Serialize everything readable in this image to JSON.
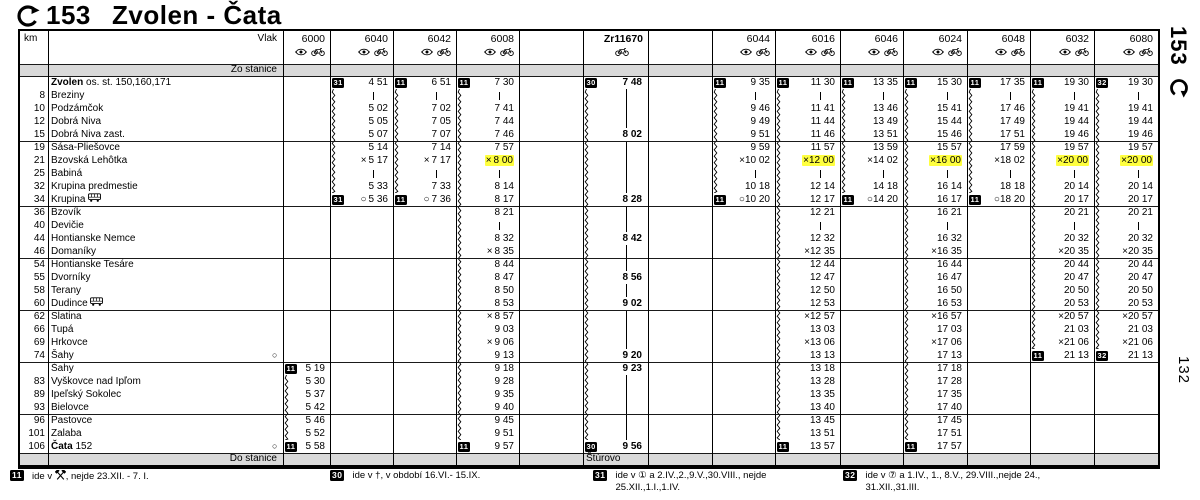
{
  "title": {
    "route_number": "153",
    "name": "Zvolen - Čata"
  },
  "margin": {
    "route": "153",
    "page": "132"
  },
  "header": {
    "km": "km",
    "vlak": "Vlak",
    "zo": "Zo stanice",
    "do": "Do stanice"
  },
  "colors": {
    "highlight": "#ffff3f",
    "band_gray": "#d9d9d9",
    "ink": "#000000",
    "paper": "#ffffff"
  },
  "stations": [
    {
      "km": "",
      "name": "Zvolen",
      "suffix": "os. st. 150,160,171",
      "bold": true
    },
    {
      "km": "8",
      "name": "Breziny"
    },
    {
      "km": "10",
      "name": "Podzámčok"
    },
    {
      "km": "12",
      "name": "Dobrá Niva"
    },
    {
      "km": "15",
      "name": "Dobrá Niva zast."
    },
    {
      "km": "19",
      "name": "Sása-Pliešovce"
    },
    {
      "km": "21",
      "name": "Bzovská Lehôtka"
    },
    {
      "km": "25",
      "name": "Babiná"
    },
    {
      "km": "32",
      "name": "Krupina predmestie"
    },
    {
      "km": "34",
      "name": "Krupina",
      "bus": true
    },
    {
      "km": "36",
      "name": "Bzovík"
    },
    {
      "km": "40",
      "name": "Devičie"
    },
    {
      "km": "44",
      "name": "Hontianske Nemce"
    },
    {
      "km": "46",
      "name": "Domaníky"
    },
    {
      "km": "54",
      "name": "Hontianske Tesáre"
    },
    {
      "km": "55",
      "name": "Dvorníky"
    },
    {
      "km": "58",
      "name": "Terany"
    },
    {
      "km": "60",
      "name": "Dudince",
      "bus": true
    },
    {
      "km": "62",
      "name": "Slatina"
    },
    {
      "km": "66",
      "name": "Tupá"
    },
    {
      "km": "69",
      "name": "Hrkovce"
    },
    {
      "km": "74",
      "name": "Šahy",
      "circle": true
    },
    {
      "km": "",
      "name": "Šahy"
    },
    {
      "km": "83",
      "name": "Vyškovce nad Ipľom"
    },
    {
      "km": "89",
      "name": "Ipeľský Sokolec"
    },
    {
      "km": "93",
      "name": "Bielovce"
    },
    {
      "km": "96",
      "name": "Pastovce"
    },
    {
      "km": "101",
      "name": "Zalaba"
    },
    {
      "km": "106",
      "name": "Čata",
      "suffix": "152",
      "bold": true,
      "circle": true
    }
  ],
  "section_breaks": [
    4,
    9,
    13,
    17,
    21,
    25
  ],
  "columns": [
    {
      "number": "6000",
      "icons": [
        "eye",
        "bike"
      ],
      "wavy": [
        23,
        27
      ],
      "cells": [
        "",
        "",
        "",
        "",
        "",
        "",
        "",
        "",
        "",
        "",
        "",
        "",
        "",
        "",
        "",
        "",
        "",
        "",
        "",
        "",
        "",
        "",
        {
          "b": "11",
          "t": "5 19"
        },
        "5 30",
        "5 37",
        "5 42",
        "5 46",
        "5 52",
        {
          "b": "11",
          "t": "5 58"
        }
      ]
    },
    {
      "number": "6040",
      "icons": [
        "eye",
        "bike"
      ],
      "wavy": [
        1,
        8
      ],
      "cells": [
        {
          "b": "31",
          "t": "4 51"
        },
        "|",
        "5 02",
        "5 05",
        "5 07",
        "5 14",
        {
          "p": "×",
          "t": "5 17"
        },
        "|",
        "5 33",
        {
          "b": "31",
          "p": "○",
          "t": "5 36"
        },
        "",
        "",
        "",
        "",
        "",
        "",
        "",
        "",
        "",
        "",
        "",
        "",
        "",
        "",
        "",
        "",
        "",
        "",
        ""
      ]
    },
    {
      "number": "6042",
      "icons": [
        "eye",
        "bike"
      ],
      "wavy": [
        1,
        8
      ],
      "cells": [
        {
          "b": "11",
          "t": "6 51"
        },
        "|",
        "7 02",
        "7 05",
        "7 07",
        "7 14",
        {
          "p": "×",
          "t": "7 17"
        },
        "|",
        "7 33",
        {
          "b": "11",
          "p": "○",
          "t": "7 36"
        },
        "",
        "",
        "",
        "",
        "",
        "",
        "",
        "",
        "",
        "",
        "",
        "",
        "",
        "",
        "",
        "",
        "",
        "",
        ""
      ]
    },
    {
      "number": "6008",
      "icons": [
        "eye",
        "bike"
      ],
      "wavy": [
        1,
        27
      ],
      "cells": [
        {
          "b": "11",
          "t": "7 30"
        },
        "|",
        "7 41",
        "7 44",
        "7 46",
        "7 57",
        {
          "p": "×",
          "t": "8 00",
          "h": true
        },
        "|",
        "8 14",
        "8 17",
        "8 21",
        "|",
        "8 32",
        {
          "p": "×",
          "t": "8 35"
        },
        "8 44",
        "8 47",
        "8 50",
        "8 53",
        {
          "p": "×",
          "t": "8 57"
        },
        "9 03",
        {
          "p": "×",
          "t": "9 06"
        },
        "9 13",
        "9 18",
        "9 28",
        "9 35",
        "9 40",
        "9 45",
        "9 51",
        {
          "b": "11",
          "t": "9 57"
        }
      ]
    },
    {
      "number": "",
      "icons": [],
      "cells": []
    },
    {
      "number": "Zr11670",
      "bold": true,
      "icons": [
        "bike"
      ],
      "wavy": [
        1,
        27
      ],
      "destination": "Štúrovo",
      "cells": [
        {
          "b": "30",
          "t": "7 48"
        },
        "l",
        "l",
        "l",
        "8 02",
        "l",
        "l",
        "l",
        "l",
        "8 28",
        "l",
        "l",
        "8 42",
        "l",
        "l",
        "8 56",
        "l",
        "9 02",
        "l",
        "l",
        "l",
        "9 20",
        "9 23",
        "l",
        "l",
        "l",
        "l",
        "l",
        {
          "b": "30",
          "t": "9 56"
        }
      ]
    },
    {
      "number": "",
      "icons": [],
      "cells": []
    },
    {
      "number": "6044",
      "icons": [
        "eye",
        "bike"
      ],
      "wavy": [
        1,
        8
      ],
      "cells": [
        {
          "b": "11",
          "t": "9 35"
        },
        "|",
        "9 46",
        "9 49",
        "9 51",
        "9 59",
        {
          "p": "×",
          "t": "10 02"
        },
        "|",
        "10 18",
        {
          "b": "11",
          "p": "○",
          "t": "10 20"
        },
        "",
        "",
        "",
        "",
        "",
        "",
        "",
        "",
        "",
        "",
        "",
        "",
        "",
        "",
        "",
        "",
        "",
        "",
        ""
      ]
    },
    {
      "number": "6016",
      "icons": [
        "eye",
        "bike"
      ],
      "wavy": [
        1,
        27
      ],
      "cells": [
        {
          "b": "11",
          "t": "11 30"
        },
        "|",
        "11 41",
        "11 44",
        "11 46",
        "11 57",
        {
          "p": "×",
          "t": "12 00",
          "h": true
        },
        "|",
        "12 14",
        "12 17",
        "12 21",
        "|",
        "12 32",
        {
          "p": "×",
          "t": "12 35"
        },
        "12 44",
        "12 47",
        "12 50",
        "12 53",
        {
          "p": "×",
          "t": "12 57"
        },
        "13 03",
        {
          "p": "×",
          "t": "13 06"
        },
        "13 13",
        "13 18",
        "13 28",
        "13 35",
        "13 40",
        "13 45",
        "13 51",
        {
          "b": "11",
          "t": "13 57"
        }
      ]
    },
    {
      "number": "6046",
      "icons": [
        "eye",
        "bike"
      ],
      "wavy": [
        1,
        8
      ],
      "cells": [
        {
          "b": "11",
          "t": "13 35"
        },
        "|",
        "13 46",
        "13 49",
        "13 51",
        "13 59",
        {
          "p": "×",
          "t": "14 02"
        },
        "|",
        "14 18",
        {
          "b": "11",
          "p": "○",
          "t": "14 20"
        },
        "",
        "",
        "",
        "",
        "",
        "",
        "",
        "",
        "",
        "",
        "",
        "",
        "",
        "",
        "",
        "",
        "",
        "",
        ""
      ]
    },
    {
      "number": "6024",
      "icons": [
        "eye",
        "bike"
      ],
      "wavy": [
        1,
        27
      ],
      "cells": [
        {
          "b": "11",
          "t": "15 30"
        },
        "|",
        "15 41",
        "15 44",
        "15 46",
        "15 57",
        {
          "p": "×",
          "t": "16 00",
          "h": true
        },
        "|",
        "16 14",
        "16 17",
        "16 21",
        "|",
        "16 32",
        {
          "p": "×",
          "t": "16 35"
        },
        "16 44",
        "16 47",
        "16 50",
        "16 53",
        {
          "p": "×",
          "t": "16 57"
        },
        "17 03",
        {
          "p": "×",
          "t": "17 06"
        },
        "17 13",
        "17 18",
        "17 28",
        "17 35",
        "17 40",
        "17 45",
        "17 51",
        {
          "b": "11",
          "t": "17 57"
        }
      ]
    },
    {
      "number": "6048",
      "icons": [
        "eye",
        "bike"
      ],
      "wavy": [
        1,
        8
      ],
      "cells": [
        {
          "b": "11",
          "t": "17 35"
        },
        "|",
        "17 46",
        "17 49",
        "17 51",
        "17 59",
        {
          "p": "×",
          "t": "18 02"
        },
        "|",
        "18 18",
        {
          "b": "11",
          "p": "○",
          "t": "18 20"
        },
        "",
        "",
        "",
        "",
        "",
        "",
        "",
        "",
        "",
        "",
        "",
        "",
        "",
        "",
        "",
        "",
        "",
        "",
        ""
      ]
    },
    {
      "number": "6032",
      "icons": [
        "eye",
        "bike"
      ],
      "wavy": [
        1,
        20
      ],
      "cells": [
        {
          "b": "11",
          "t": "19 30"
        },
        "|",
        "19 41",
        "19 44",
        "19 46",
        "19 57",
        {
          "p": "×",
          "t": "20 00",
          "h": true
        },
        "|",
        "20 14",
        "20 17",
        "20 21",
        "|",
        "20 32",
        {
          "p": "×",
          "t": "20 35"
        },
        "20 44",
        "20 47",
        "20 50",
        "20 53",
        {
          "p": "×",
          "t": "20 57"
        },
        "21 03",
        {
          "p": "×",
          "t": "21 06"
        },
        {
          "b": "11",
          "t": "21 13"
        },
        "",
        "",
        "",
        "",
        "",
        "",
        ""
      ]
    },
    {
      "number": "6080",
      "icons": [
        "eye",
        "bike"
      ],
      "wavy": [
        1,
        20
      ],
      "cells": [
        {
          "b": "32",
          "t": "19 30"
        },
        "|",
        "19 41",
        "19 44",
        "19 46",
        "19 57",
        {
          "p": "×",
          "t": "20 00",
          "h": true
        },
        "|",
        "20 14",
        "20 17",
        "20 21",
        "|",
        "20 32",
        {
          "p": "×",
          "t": "20 35"
        },
        "20 44",
        "20 47",
        "20 50",
        "20 53",
        {
          "p": "×",
          "t": "20 57"
        },
        "21 03",
        {
          "p": "×",
          "t": "21 06"
        },
        {
          "b": "32",
          "t": "21 13"
        },
        "",
        "",
        "",
        "",
        "",
        "",
        ""
      ]
    }
  ],
  "notes": [
    {
      "badge": "11",
      "pre": "ide v ",
      "icon": "hammers",
      "post": ", nejde 23.XII. - 7. I."
    },
    {
      "badge": "30",
      "pre": "ide v †, v období 16.VI.- 15.IX."
    },
    {
      "badge": "31",
      "pre": "ide v ① a 2.IV.,2.,9.V.,30.VIII., nejde",
      "line2": "25.XII.,1.I.,1.IV."
    },
    {
      "badge": "32",
      "pre": "ide v ⑦ a 1.IV., 1., 8.V., 29.VIII.,nejde 24.,",
      "line2": "31.XII.,31.III."
    }
  ]
}
